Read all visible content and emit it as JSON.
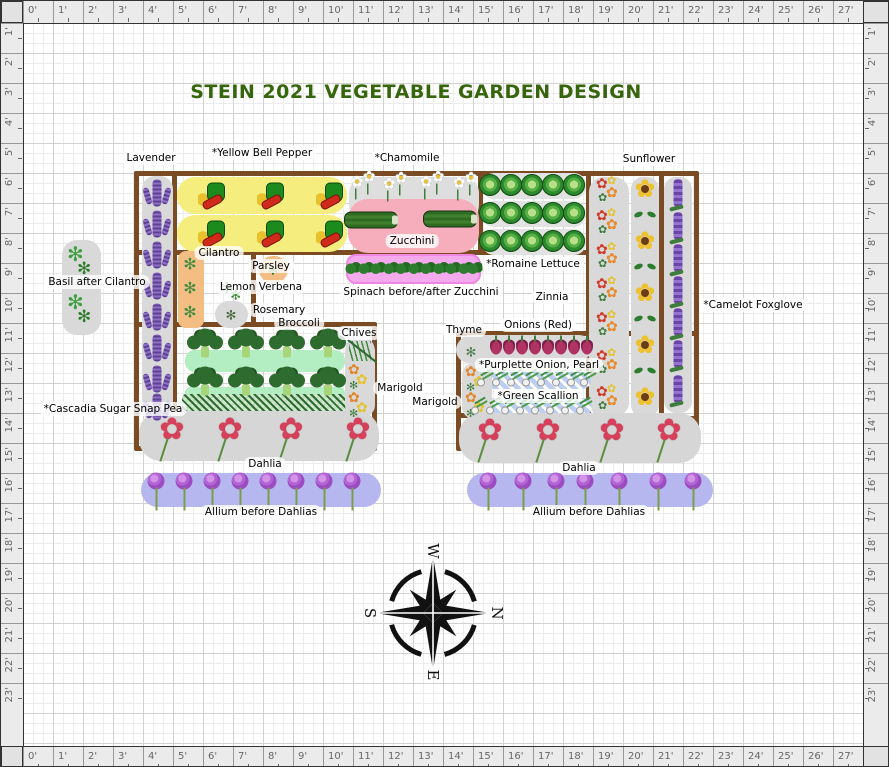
{
  "title": "STEIN 2021 VEGETABLE GARDEN DESIGN",
  "rulers": {
    "top": [
      "0'",
      "1'",
      "2'",
      "3'",
      "4'",
      "5'",
      "6'",
      "7'",
      "8'",
      "9'",
      "10'",
      "11'",
      "12'",
      "13'",
      "14'",
      "15'",
      "16'",
      "17'",
      "18'",
      "19'",
      "20'",
      "21'",
      "22'",
      "23'",
      "24'",
      "25'",
      "26'",
      "27'"
    ],
    "bottom": [
      "0'",
      "1'",
      "2'",
      "3'",
      "4'",
      "5'",
      "6'",
      "7'",
      "8'",
      "9'",
      "10'",
      "11'",
      "12'",
      "13'",
      "14'",
      "15'",
      "16'",
      "17'",
      "18'",
      "19'",
      "20'",
      "21'",
      "22'",
      "23'",
      "24'",
      "25'",
      "26'",
      "27'"
    ],
    "left": [
      "1'",
      "2'",
      "3'",
      "4'",
      "5'",
      "6'",
      "7'",
      "8'",
      "9'",
      "10'",
      "11'",
      "12'",
      "13'",
      "14'",
      "15'",
      "16'",
      "17'",
      "18'",
      "19'",
      "20'",
      "21'",
      "22'",
      "23'"
    ],
    "right": [
      "1'",
      "2'",
      "3'",
      "4'",
      "5'",
      "6'",
      "7'",
      "8'",
      "9'",
      "10'",
      "11'",
      "12'",
      "13'",
      "14'",
      "15'",
      "16'",
      "17'",
      "18'",
      "19'",
      "20'",
      "21'",
      "22'",
      "23'"
    ]
  },
  "compass": {
    "n": "N",
    "s": "S",
    "e": "E",
    "w": "W"
  },
  "colors": {
    "bed_border": "#7b4b24",
    "title_green": "#35660b",
    "strip_gray": "#d9d9d9",
    "pepper_yellow": "#f5ee7e",
    "zucchini_pink": "#f6aebc",
    "spinach_pink": "#f6aaee",
    "allium_periwinkle": "#b7b7ef",
    "broccoli_green": "#b2eec2",
    "cilantro_orange": "#f4bd84",
    "chives_blue": "#b9bcf2"
  },
  "beds": [
    {
      "name": "bed-top-band",
      "x": 133,
      "y": 170,
      "w": 457,
      "h": 84
    },
    {
      "name": "bed-right-columns",
      "x": 585,
      "y": 170,
      "w": 113,
      "h": 250
    },
    {
      "name": "bed-left-arm-upper",
      "x": 133,
      "y": 249,
      "w": 122,
      "h": 77
    },
    {
      "name": "bed-left-arm-lower",
      "x": 133,
      "y": 321,
      "w": 243,
      "h": 129
    },
    {
      "name": "bed-right",
      "x": 455,
      "y": 330,
      "w": 243,
      "h": 120
    }
  ],
  "bed_segments": [
    {
      "name": "divider-lavender",
      "x": 171,
      "y": 170,
      "w": 5,
      "h": 245
    },
    {
      "name": "divider-columns",
      "x": 658,
      "y": 170,
      "w": 5,
      "h": 250
    },
    {
      "name": "divider-romaine",
      "x": 477,
      "y": 170,
      "w": 5,
      "h": 84
    },
    {
      "name": "divider-right-bed",
      "x": 455,
      "y": 412,
      "w": 138,
      "h": 5
    }
  ],
  "strips": [
    {
      "name": "lavender-strip",
      "x": 141,
      "y": 175,
      "w": 31,
      "h": 246,
      "bg": "#d9d9d9",
      "r": 13
    },
    {
      "name": "pepper-row-a",
      "x": 176,
      "y": 176,
      "w": 170,
      "h": 37,
      "bg": "#f5ee7e",
      "r": 18
    },
    {
      "name": "pepper-row-b",
      "x": 176,
      "y": 214,
      "w": 170,
      "h": 37,
      "bg": "#f5ee7e",
      "r": 18
    },
    {
      "name": "chamomile-area",
      "x": 348,
      "y": 176,
      "w": 130,
      "h": 44,
      "bg": "#dedede",
      "r": 16
    },
    {
      "name": "zucchini-area",
      "x": 347,
      "y": 198,
      "w": 131,
      "h": 54,
      "bg": "#f6aebc",
      "r": 20
    },
    {
      "name": "romaine-row-a",
      "x": 481,
      "y": 172,
      "w": 104,
      "h": 26,
      "bg": "#e2e2e2",
      "r": 12
    },
    {
      "name": "romaine-row-b",
      "x": 481,
      "y": 200,
      "w": 104,
      "h": 26,
      "bg": "#e2e2e2",
      "r": 12
    },
    {
      "name": "romaine-row-c",
      "x": 481,
      "y": 228,
      "w": 104,
      "h": 26,
      "bg": "#e2e2e2",
      "r": 12
    },
    {
      "name": "zinnia-strip",
      "x": 588,
      "y": 176,
      "w": 40,
      "h": 240,
      "bg": "#d9d9d9",
      "r": 15
    },
    {
      "name": "sunflower-strip",
      "x": 630,
      "y": 176,
      "w": 28,
      "h": 240,
      "bg": "#d9d9d9",
      "r": 12
    },
    {
      "name": "foxglove-strip",
      "x": 663,
      "y": 176,
      "w": 28,
      "h": 236,
      "bg": "#d9d9d9",
      "r": 12
    },
    {
      "name": "basil-strip",
      "x": 61,
      "y": 239,
      "w": 39,
      "h": 95,
      "bg": "#d9d9d9",
      "r": 15
    },
    {
      "name": "cilantro-strip",
      "x": 177,
      "y": 250,
      "w": 26,
      "h": 77,
      "bg": "#f4bd84",
      "r": 8
    },
    {
      "name": "parsley-circle",
      "x": 258,
      "y": 255,
      "w": 29,
      "h": 27,
      "bg": "#f4bd84",
      "r": 14
    },
    {
      "name": "rosemary-circle",
      "x": 214,
      "y": 300,
      "w": 33,
      "h": 27,
      "bg": "#d9d9d9",
      "r": 14
    },
    {
      "name": "broccoli-bg-a",
      "x": 184,
      "y": 349,
      "w": 160,
      "h": 22,
      "bg": "#b2eec2",
      "r": 10
    },
    {
      "name": "broccoli-bg-b",
      "x": 184,
      "y": 386,
      "w": 160,
      "h": 13,
      "bg": "#b2eec2",
      "r": 6
    },
    {
      "name": "pea-strip",
      "x": 181,
      "y": 393,
      "w": 183,
      "h": 21,
      "cls": "st-pea",
      "r": 4
    },
    {
      "name": "chives-bg",
      "x": 345,
      "y": 338,
      "w": 28,
      "h": 25,
      "bg": "#b9bcf2",
      "r": 8
    },
    {
      "name": "marigold-left-strip",
      "x": 344,
      "y": 338,
      "w": 30,
      "h": 78,
      "bg": "#d9d9d9",
      "r": 12
    },
    {
      "name": "dahlia-left-strip",
      "x": 138,
      "y": 410,
      "w": 240,
      "h": 50,
      "bg": "#d6d6d6",
      "r": 22
    },
    {
      "name": "allium-left-strip",
      "x": 140,
      "y": 472,
      "w": 240,
      "h": 34,
      "bg": "#b7b7ef",
      "r": 17
    },
    {
      "name": "spinach-strip",
      "x": 345,
      "y": 253,
      "w": 135,
      "h": 30,
      "bg": "#f6aaee",
      "r": 10,
      "border": "2px solid #ee86e2"
    },
    {
      "name": "thyme-circle",
      "x": 455,
      "y": 336,
      "w": 30,
      "h": 26,
      "bg": "#d9d9d9",
      "r": 14
    },
    {
      "name": "onion-strip",
      "x": 457,
      "y": 334,
      "w": 133,
      "h": 26,
      "bg": "#d9d9d9",
      "r": 12
    },
    {
      "name": "purplette-strip",
      "x": 476,
      "y": 369,
      "w": 114,
      "h": 19,
      "cls": "st-bluehatch",
      "r": 9
    },
    {
      "name": "scallion-strip",
      "x": 470,
      "y": 397,
      "w": 121,
      "h": 18,
      "cls": "st-bluehatch",
      "r": 9
    },
    {
      "name": "marigold-right-strip",
      "x": 461,
      "y": 362,
      "w": 30,
      "h": 56,
      "bg": "#d9d9d9",
      "r": 12
    },
    {
      "name": "dahlia-right-strip",
      "x": 458,
      "y": 412,
      "w": 242,
      "h": 50,
      "bg": "#d6d6d6",
      "r": 22
    },
    {
      "name": "allium-right-strip",
      "x": 466,
      "y": 472,
      "w": 246,
      "h": 34,
      "bg": "#b7b7ef",
      "r": 17
    }
  ],
  "labels": [
    {
      "name": "label-lavender",
      "text": "Lavender",
      "x": 150,
      "y": 157
    },
    {
      "name": "label-yellow-bell-pepper",
      "text": "*Yellow Bell Pepper",
      "x": 261,
      "y": 152
    },
    {
      "name": "label-chamomile",
      "text": "*Chamomile",
      "x": 406,
      "y": 157
    },
    {
      "name": "label-sunflower",
      "text": "Sunflower",
      "x": 648,
      "y": 158
    },
    {
      "name": "label-basil-after-cilantro",
      "text": "Basil after Cilantro",
      "x": 96,
      "y": 281
    },
    {
      "name": "label-cilantro",
      "text": "Cilantro",
      "x": 218,
      "y": 252
    },
    {
      "name": "label-parsley",
      "text": "Parsley",
      "x": 270,
      "y": 265
    },
    {
      "name": "label-lemon-verbena",
      "text": "Lemon Verbena",
      "x": 260,
      "y": 286
    },
    {
      "name": "label-rosemary",
      "text": "Rosemary",
      "x": 278,
      "y": 309
    },
    {
      "name": "label-broccoli",
      "text": "Broccoli",
      "x": 298,
      "y": 322
    },
    {
      "name": "label-zucchini",
      "text": "Zucchini",
      "x": 411,
      "y": 240
    },
    {
      "name": "label-romaine-lettuce",
      "text": "*Romaine Lettuce",
      "x": 532,
      "y": 263
    },
    {
      "name": "label-spinach",
      "text": "Spinach before/after Zucchini",
      "x": 420,
      "y": 291
    },
    {
      "name": "label-zinnia",
      "text": "Zinnia",
      "x": 551,
      "y": 296
    },
    {
      "name": "label-camelot-foxglove",
      "text": "*Camelot Foxglove",
      "x": 752,
      "y": 304
    },
    {
      "name": "label-chives",
      "text": "Chives",
      "x": 358,
      "y": 332
    },
    {
      "name": "label-thyme",
      "text": "Thyme",
      "x": 463,
      "y": 329
    },
    {
      "name": "label-onions-red",
      "text": "Onions (Red)",
      "x": 537,
      "y": 324
    },
    {
      "name": "label-purplette-onion",
      "text": "*Purplette Onion, Pearl",
      "x": 538,
      "y": 364
    },
    {
      "name": "label-green-scallion",
      "text": "*Green Scallion",
      "x": 537,
      "y": 395
    },
    {
      "name": "label-marigold-left",
      "text": "Marigold",
      "x": 399,
      "y": 387
    },
    {
      "name": "label-marigold-right",
      "text": "Marigold",
      "x": 434,
      "y": 401
    },
    {
      "name": "label-cascadia-sugar-snap-pea",
      "text": "*Cascadia Sugar Snap Pea",
      "x": 112,
      "y": 408
    },
    {
      "name": "label-dahlia-left",
      "text": "Dahlia",
      "x": 264,
      "y": 463
    },
    {
      "name": "label-dahlia-right",
      "text": "Dahlia",
      "x": 578,
      "y": 467
    },
    {
      "name": "label-allium-left",
      "text": "Allium before Dahlias",
      "x": 260,
      "y": 511
    },
    {
      "name": "label-allium-right",
      "text": "Allium before Dahlias",
      "x": 588,
      "y": 511
    }
  ],
  "icons": [
    {
      "t": "lavender",
      "x": 156,
      "y": 192
    },
    {
      "t": "lavender",
      "x": 156,
      "y": 223
    },
    {
      "t": "lavender",
      "x": 156,
      "y": 254
    },
    {
      "t": "lavender",
      "x": 156,
      "y": 285
    },
    {
      "t": "lavender",
      "x": 156,
      "y": 316
    },
    {
      "t": "lavender",
      "x": 156,
      "y": 347
    },
    {
      "t": "lavender",
      "x": 156,
      "y": 378
    },
    {
      "t": "lavender",
      "x": 156,
      "y": 406
    },
    {
      "t": "pepper",
      "x": 213,
      "y": 195
    },
    {
      "t": "pepper",
      "x": 272,
      "y": 195
    },
    {
      "t": "pepper",
      "x": 331,
      "y": 195
    },
    {
      "t": "pepper",
      "x": 213,
      "y": 233
    },
    {
      "t": "pepper",
      "x": 272,
      "y": 233
    },
    {
      "t": "pepper",
      "x": 331,
      "y": 233
    },
    {
      "t": "daisy",
      "x": 356,
      "y": 186
    },
    {
      "t": "daisy",
      "x": 368,
      "y": 181
    },
    {
      "t": "daisy",
      "x": 388,
      "y": 188
    },
    {
      "t": "daisy",
      "x": 400,
      "y": 182
    },
    {
      "t": "daisy",
      "x": 425,
      "y": 186
    },
    {
      "t": "daisy",
      "x": 437,
      "y": 181
    },
    {
      "t": "daisy",
      "x": 458,
      "y": 187
    },
    {
      "t": "daisy",
      "x": 470,
      "y": 182
    },
    {
      "t": "zucchini",
      "x": 370,
      "y": 219
    },
    {
      "t": "zucchini",
      "x": 449,
      "y": 218
    },
    {
      "t": "lettuce",
      "x": 489,
      "y": 184
    },
    {
      "t": "lettuce",
      "x": 510,
      "y": 184
    },
    {
      "t": "lettuce",
      "x": 531,
      "y": 184
    },
    {
      "t": "lettuce",
      "x": 552,
      "y": 184
    },
    {
      "t": "lettuce",
      "x": 573,
      "y": 184
    },
    {
      "t": "lettuce",
      "x": 489,
      "y": 212
    },
    {
      "t": "lettuce",
      "x": 510,
      "y": 212
    },
    {
      "t": "lettuce",
      "x": 531,
      "y": 212
    },
    {
      "t": "lettuce",
      "x": 552,
      "y": 212
    },
    {
      "t": "lettuce",
      "x": 573,
      "y": 212
    },
    {
      "t": "lettuce",
      "x": 489,
      "y": 240
    },
    {
      "t": "lettuce",
      "x": 510,
      "y": 240
    },
    {
      "t": "lettuce",
      "x": 531,
      "y": 240
    },
    {
      "t": "lettuce",
      "x": 552,
      "y": 240
    },
    {
      "t": "lettuce",
      "x": 573,
      "y": 240
    },
    {
      "t": "zinnia",
      "x": 607,
      "y": 190
    },
    {
      "t": "zinnia",
      "x": 607,
      "y": 222
    },
    {
      "t": "zinnia",
      "x": 607,
      "y": 256
    },
    {
      "t": "zinnia",
      "x": 607,
      "y": 290
    },
    {
      "t": "zinnia",
      "x": 607,
      "y": 324
    },
    {
      "t": "zinnia",
      "x": 607,
      "y": 362
    },
    {
      "t": "zinnia",
      "x": 607,
      "y": 398
    },
    {
      "t": "sunflower",
      "x": 644,
      "y": 188
    },
    {
      "t": "sunleaf",
      "x": 644,
      "y": 214
    },
    {
      "t": "sunflower",
      "x": 644,
      "y": 240
    },
    {
      "t": "sunleaf",
      "x": 644,
      "y": 266
    },
    {
      "t": "sunflower",
      "x": 644,
      "y": 292
    },
    {
      "t": "sunleaf",
      "x": 644,
      "y": 318
    },
    {
      "t": "sunflower",
      "x": 644,
      "y": 344
    },
    {
      "t": "sunleaf",
      "x": 644,
      "y": 370
    },
    {
      "t": "sunflower",
      "x": 644,
      "y": 396
    },
    {
      "t": "foxglove",
      "x": 677,
      "y": 192
    },
    {
      "t": "foxglove",
      "x": 677,
      "y": 225
    },
    {
      "t": "foxglove",
      "x": 677,
      "y": 257
    },
    {
      "t": "foxglove",
      "x": 677,
      "y": 289
    },
    {
      "t": "foxglove",
      "x": 677,
      "y": 321
    },
    {
      "t": "foxglove",
      "x": 677,
      "y": 353
    },
    {
      "t": "foxglove",
      "x": 677,
      "y": 388
    },
    {
      "t": "basil",
      "x": 80,
      "y": 262
    },
    {
      "t": "basil",
      "x": 80,
      "y": 310
    },
    {
      "t": "cilantro",
      "x": 189,
      "y": 263
    },
    {
      "t": "cilantro",
      "x": 189,
      "y": 287
    },
    {
      "t": "cilantro",
      "x": 189,
      "y": 311
    },
    {
      "t": "parsley",
      "x": 272,
      "y": 268
    },
    {
      "t": "verbena",
      "x": 226,
      "y": 287
    },
    {
      "t": "rosemary",
      "x": 230,
      "y": 313
    },
    {
      "t": "thyme",
      "x": 470,
      "y": 350
    },
    {
      "t": "broccoli",
      "x": 204,
      "y": 341
    },
    {
      "t": "broccoli",
      "x": 245,
      "y": 341
    },
    {
      "t": "broccoli",
      "x": 286,
      "y": 341
    },
    {
      "t": "broccoli",
      "x": 327,
      "y": 341
    },
    {
      "t": "broccoli",
      "x": 204,
      "y": 379
    },
    {
      "t": "broccoli",
      "x": 245,
      "y": 379
    },
    {
      "t": "broccoli",
      "x": 286,
      "y": 379
    },
    {
      "t": "broccoli",
      "x": 327,
      "y": 379
    },
    {
      "t": "chives",
      "x": 359,
      "y": 350
    },
    {
      "t": "marigold",
      "x": 358,
      "y": 376
    },
    {
      "t": "marigold",
      "x": 358,
      "y": 404
    },
    {
      "t": "marigold",
      "x": 475,
      "y": 378
    },
    {
      "t": "marigold",
      "x": 475,
      "y": 404
    },
    {
      "t": "dahlia",
      "x": 171,
      "y": 429
    },
    {
      "t": "dahlia",
      "x": 229,
      "y": 429
    },
    {
      "t": "dahlia",
      "x": 290,
      "y": 429
    },
    {
      "t": "dahlia",
      "x": 357,
      "y": 429
    },
    {
      "t": "dahlia",
      "x": 489,
      "y": 430
    },
    {
      "t": "dahlia",
      "x": 547,
      "y": 430
    },
    {
      "t": "dahlia",
      "x": 611,
      "y": 430
    },
    {
      "t": "dahlia",
      "x": 668,
      "y": 430
    },
    {
      "t": "allium",
      "x": 155,
      "y": 480
    },
    {
      "t": "allium",
      "x": 183,
      "y": 480
    },
    {
      "t": "allium",
      "x": 211,
      "y": 480
    },
    {
      "t": "allium",
      "x": 239,
      "y": 480
    },
    {
      "t": "allium",
      "x": 267,
      "y": 480
    },
    {
      "t": "allium",
      "x": 295,
      "y": 480
    },
    {
      "t": "allium",
      "x": 323,
      "y": 480
    },
    {
      "t": "allium",
      "x": 351,
      "y": 480
    },
    {
      "t": "allium",
      "x": 487,
      "y": 480
    },
    {
      "t": "allium",
      "x": 522,
      "y": 480
    },
    {
      "t": "allium",
      "x": 555,
      "y": 480
    },
    {
      "t": "allium",
      "x": 584,
      "y": 480
    },
    {
      "t": "allium",
      "x": 618,
      "y": 480
    },
    {
      "t": "allium",
      "x": 657,
      "y": 480
    },
    {
      "t": "allium",
      "x": 692,
      "y": 480
    },
    {
      "t": "onion",
      "x": 495,
      "y": 346
    },
    {
      "t": "onion",
      "x": 508,
      "y": 346
    },
    {
      "t": "onion",
      "x": 521,
      "y": 346
    },
    {
      "t": "onion",
      "x": 534,
      "y": 346
    },
    {
      "t": "onion",
      "x": 547,
      "y": 346
    },
    {
      "t": "onion",
      "x": 560,
      "y": 346
    },
    {
      "t": "onion",
      "x": 573,
      "y": 346
    },
    {
      "t": "onion",
      "x": 586,
      "y": 346
    },
    {
      "t": "scallion",
      "x": 483,
      "y": 378
    },
    {
      "t": "scallion",
      "x": 498,
      "y": 378
    },
    {
      "t": "scallion",
      "x": 513,
      "y": 378
    },
    {
      "t": "scallion",
      "x": 528,
      "y": 378
    },
    {
      "t": "scallion",
      "x": 543,
      "y": 378
    },
    {
      "t": "scallion",
      "x": 558,
      "y": 378
    },
    {
      "t": "scallion",
      "x": 573,
      "y": 378
    },
    {
      "t": "scallion",
      "x": 586,
      "y": 378
    },
    {
      "t": "scallion",
      "x": 477,
      "y": 406
    },
    {
      "t": "scallion",
      "x": 492,
      "y": 406
    },
    {
      "t": "scallion",
      "x": 507,
      "y": 406
    },
    {
      "t": "scallion",
      "x": 522,
      "y": 406
    },
    {
      "t": "scallion",
      "x": 537,
      "y": 406
    },
    {
      "t": "scallion",
      "x": 552,
      "y": 406
    },
    {
      "t": "scallion",
      "x": 567,
      "y": 406
    },
    {
      "t": "scallion",
      "x": 582,
      "y": 406
    },
    {
      "t": "spinach",
      "x": 352,
      "y": 267
    },
    {
      "t": "spinach",
      "x": 365,
      "y": 267
    },
    {
      "t": "spinach",
      "x": 377,
      "y": 267
    },
    {
      "t": "spinach",
      "x": 390,
      "y": 267
    },
    {
      "t": "spinach",
      "x": 402,
      "y": 267
    },
    {
      "t": "spinach",
      "x": 415,
      "y": 267
    },
    {
      "t": "spinach",
      "x": 427,
      "y": 267
    },
    {
      "t": "spinach",
      "x": 440,
      "y": 267
    },
    {
      "t": "spinach",
      "x": 452,
      "y": 267
    },
    {
      "t": "spinach",
      "x": 465,
      "y": 267
    },
    {
      "t": "spinach",
      "x": 474,
      "y": 267
    }
  ]
}
